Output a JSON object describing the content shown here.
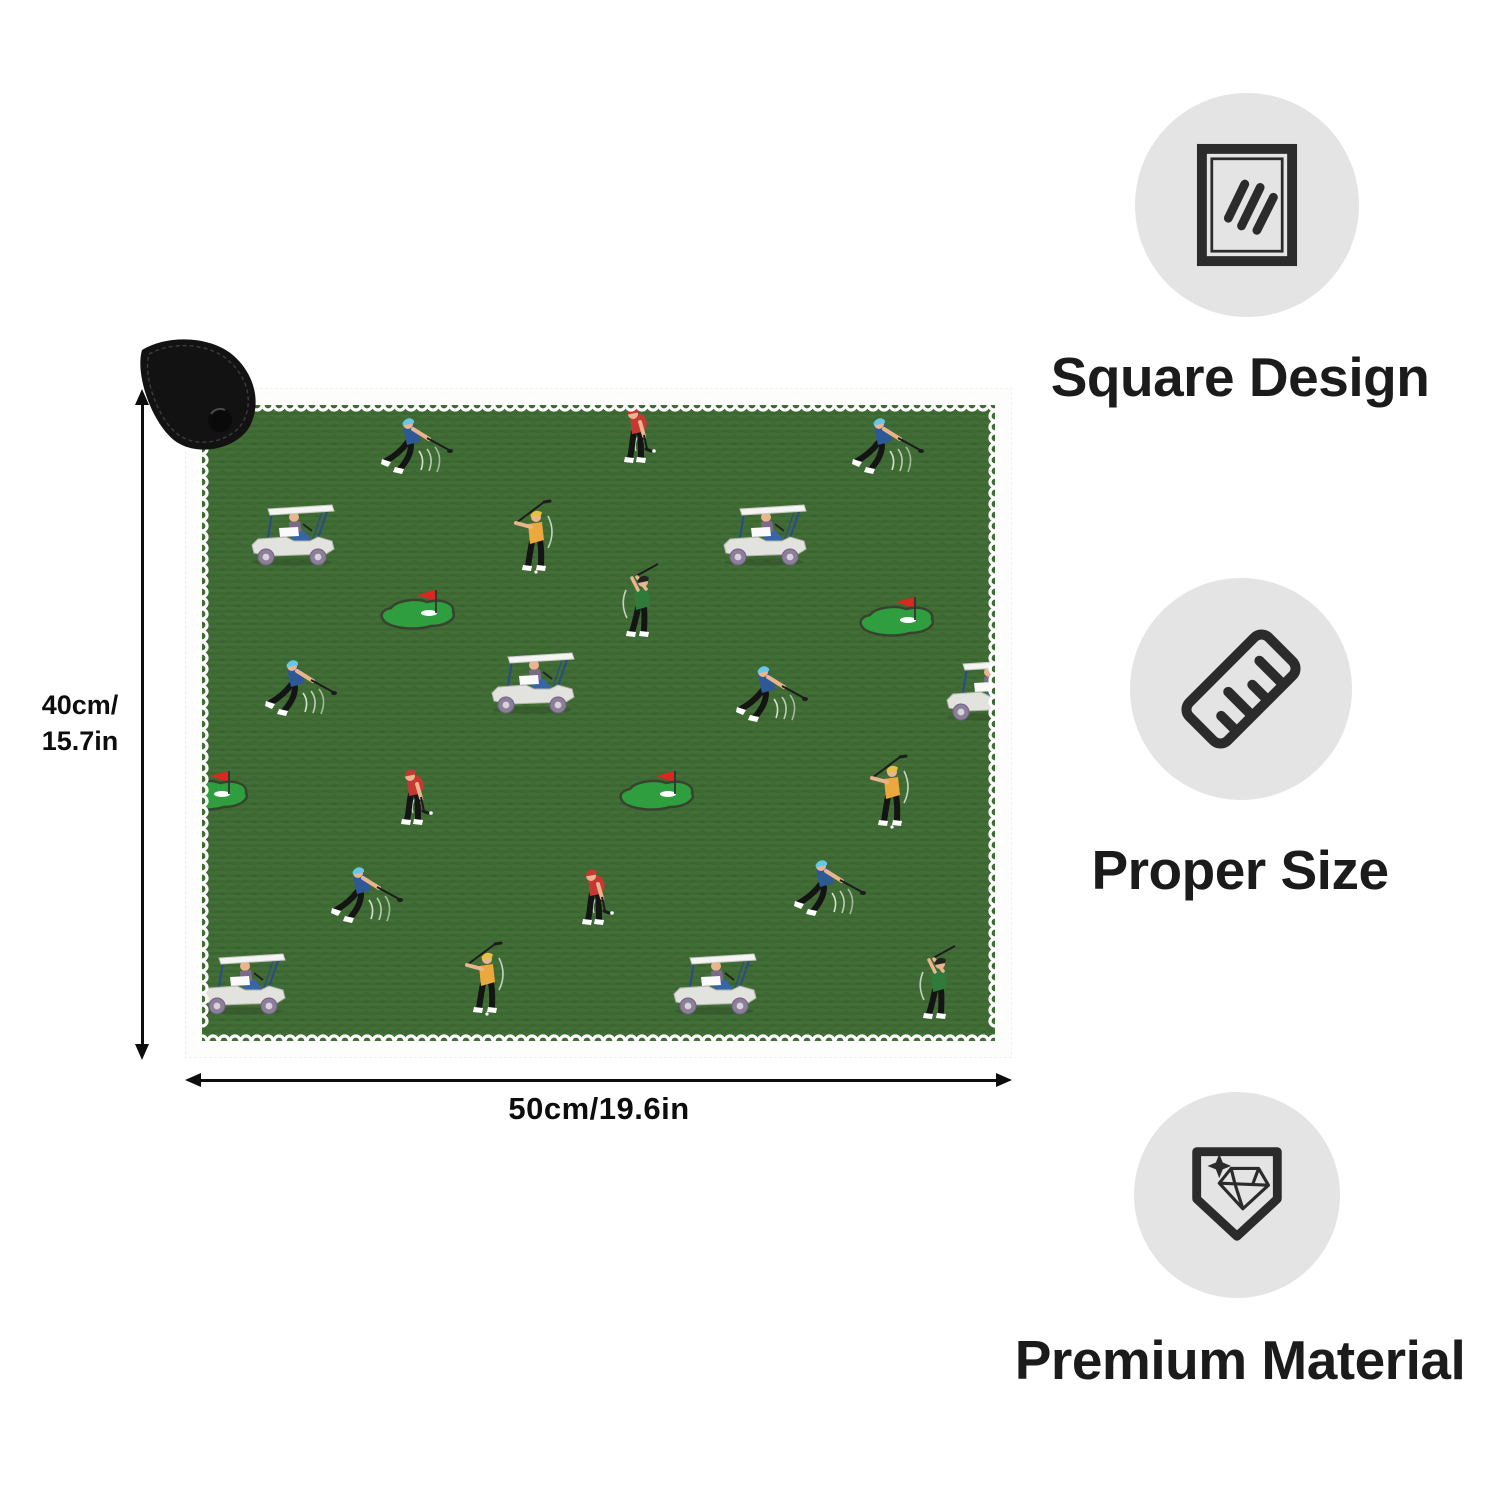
{
  "page": {
    "background": "#ffffff",
    "kind": "product dimension infographic"
  },
  "mat": {
    "fabric_color": "#426e37",
    "fabric_stripe_color": "#3e6832",
    "lace_trim_color": "#ffffff",
    "putting_green_color": "#2f9e3e",
    "flag_color": "#d8281f",
    "corner_clip_color": "#121212",
    "pattern_theme": "golfers, golf carts and putting greens with red flags",
    "pattern_items": [
      {
        "type": "golfer_blue",
        "x": 232,
        "y": 60
      },
      {
        "type": "golfer_red",
        "x": 455,
        "y": 47
      },
      {
        "type": "golfer_blue",
        "x": 703,
        "y": 60
      },
      {
        "type": "cart",
        "x": 107,
        "y": 147
      },
      {
        "type": "golfer_yellow",
        "x": 347,
        "y": 154
      },
      {
        "type": "cart",
        "x": 579,
        "y": 147
      },
      {
        "type": "flag_green",
        "x": 232,
        "y": 221
      },
      {
        "type": "golfer_green",
        "x": 455,
        "y": 221
      },
      {
        "type": "flag_green",
        "x": 711,
        "y": 228
      },
      {
        "type": "golfer_blue",
        "x": 116,
        "y": 302
      },
      {
        "type": "cart",
        "x": 347,
        "y": 295
      },
      {
        "type": "golfer_blue",
        "x": 587,
        "y": 308
      },
      {
        "type": "cart",
        "x": 802,
        "y": 302
      },
      {
        "type": "flag_green",
        "x": 25,
        "y": 402
      },
      {
        "type": "golfer_red",
        "x": 232,
        "y": 409
      },
      {
        "type": "flag_green",
        "x": 471,
        "y": 402
      },
      {
        "type": "golfer_yellow",
        "x": 703,
        "y": 409
      },
      {
        "type": "golfer_blue",
        "x": 182,
        "y": 509
      },
      {
        "type": "golfer_red",
        "x": 413,
        "y": 509
      },
      {
        "type": "golfer_blue",
        "x": 645,
        "y": 502
      },
      {
        "type": "cart",
        "x": 58,
        "y": 596
      },
      {
        "type": "golfer_yellow",
        "x": 298,
        "y": 596
      },
      {
        "type": "cart",
        "x": 529,
        "y": 596
      },
      {
        "type": "golfer_green",
        "x": 752,
        "y": 603
      }
    ]
  },
  "dimensions": {
    "height_lines": [
      "40cm/",
      "15.7in"
    ],
    "width_label": "50cm/19.6in"
  },
  "features": [
    {
      "icon": "towel-icon",
      "label": "Square Design"
    },
    {
      "icon": "ruler-icon",
      "label": "Proper Size"
    },
    {
      "icon": "premium-badge-icon",
      "label": "Premium Material"
    }
  ]
}
